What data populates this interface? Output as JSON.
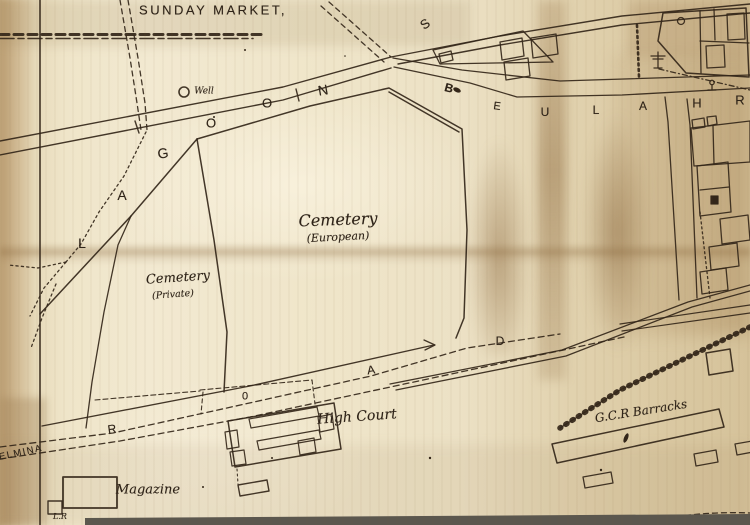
{
  "map": {
    "colors": {
      "ink": "#2e2318",
      "paper": "#ece1c5",
      "paper_shadow": "#b2946a",
      "edge_strip": "#5b574e"
    },
    "labels": [
      {
        "id": "sunday-market",
        "text": "SUNDAY MARKET,",
        "x": 213,
        "y": 10,
        "size": 13,
        "spacing": 2.5
      },
      {
        "id": "well",
        "text": "Well",
        "x": 204,
        "y": 92,
        "size": 9,
        "italic": true,
        "serif": true
      },
      {
        "id": "lagoon-l",
        "text": "L",
        "x": 82,
        "y": 243,
        "size": 14
      },
      {
        "id": "lagoon-a",
        "text": "A",
        "x": 122,
        "y": 195,
        "size": 14
      },
      {
        "id": "lagoon-g",
        "text": "G",
        "x": 163,
        "y": 153,
        "size": 14,
        "rot": -8
      },
      {
        "id": "lagoon-o1",
        "text": "O",
        "x": 211,
        "y": 123,
        "size": 13
      },
      {
        "id": "lagoon-o2",
        "text": "O",
        "x": 267,
        "y": 103,
        "size": 13
      },
      {
        "id": "lagoon-n",
        "text": "N",
        "x": 323,
        "y": 90,
        "size": 14,
        "rot": -10
      },
      {
        "id": "beulah-b",
        "text": "B",
        "x": 449,
        "y": 88,
        "size": 12,
        "rot": 15,
        "bold": true
      },
      {
        "id": "beulah-e",
        "text": "E",
        "x": 497,
        "y": 107,
        "size": 11,
        "rot": 8
      },
      {
        "id": "beulah-u",
        "text": "U",
        "x": 545,
        "y": 112,
        "size": 12
      },
      {
        "id": "beulah-l",
        "text": "L",
        "x": 596,
        "y": 110,
        "size": 12
      },
      {
        "id": "beulah-a",
        "text": "A",
        "x": 643,
        "y": 106,
        "size": 12
      },
      {
        "id": "beulah-h",
        "text": "H",
        "x": 697,
        "y": 103,
        "size": 13
      },
      {
        "id": "beulah-r",
        "text": "R",
        "x": 740,
        "y": 100,
        "size": 13
      },
      {
        "id": "street-s",
        "text": "S",
        "x": 425,
        "y": 24,
        "size": 13,
        "rot": -35
      },
      {
        "id": "cemetery-european",
        "text": "Cemetery",
        "x": 338,
        "y": 220,
        "size": 16,
        "italic": true,
        "serif": true,
        "rot": -2
      },
      {
        "id": "cemetery-european-sub",
        "text": "(European)",
        "x": 338,
        "y": 237,
        "size": 11,
        "italic": true,
        "serif": true,
        "rot": -3
      },
      {
        "id": "cemetery-private",
        "text": "Cemetery",
        "x": 178,
        "y": 278,
        "size": 13,
        "italic": true,
        "serif": true,
        "rot": -4
      },
      {
        "id": "cemetery-private-sub",
        "text": "(Private)",
        "x": 173,
        "y": 295,
        "size": 9.5,
        "italic": true,
        "serif": true,
        "rot": -4
      },
      {
        "id": "high-court",
        "text": "High Court",
        "x": 357,
        "y": 417,
        "size": 14,
        "italic": true,
        "serif": true,
        "rot": -4
      },
      {
        "id": "road-r",
        "text": "R",
        "x": 112,
        "y": 429,
        "size": 12,
        "rot": -8
      },
      {
        "id": "road-o",
        "text": "0",
        "x": 245,
        "y": 397,
        "size": 11
      },
      {
        "id": "road-a",
        "text": "A",
        "x": 371,
        "y": 370,
        "size": 12,
        "rot": -8
      },
      {
        "id": "road-d",
        "text": "D",
        "x": 500,
        "y": 341,
        "size": 12
      },
      {
        "id": "gcr-barracks",
        "text": "G.C.R Barracks",
        "x": 641,
        "y": 411,
        "size": 12,
        "rot": -9,
        "italic": true,
        "serif": true
      },
      {
        "id": "magazine",
        "text": "Magazine",
        "x": 148,
        "y": 490,
        "size": 13,
        "italic": true,
        "serif": true
      },
      {
        "id": "elmina",
        "text": "ELMINA",
        "x": 21,
        "y": 453,
        "size": 9.5,
        "rot": -12,
        "spacing": 1.5
      },
      {
        "id": "lr",
        "text": "L.R",
        "x": 60,
        "y": 517,
        "size": 8,
        "italic": true,
        "serif": true
      }
    ]
  }
}
